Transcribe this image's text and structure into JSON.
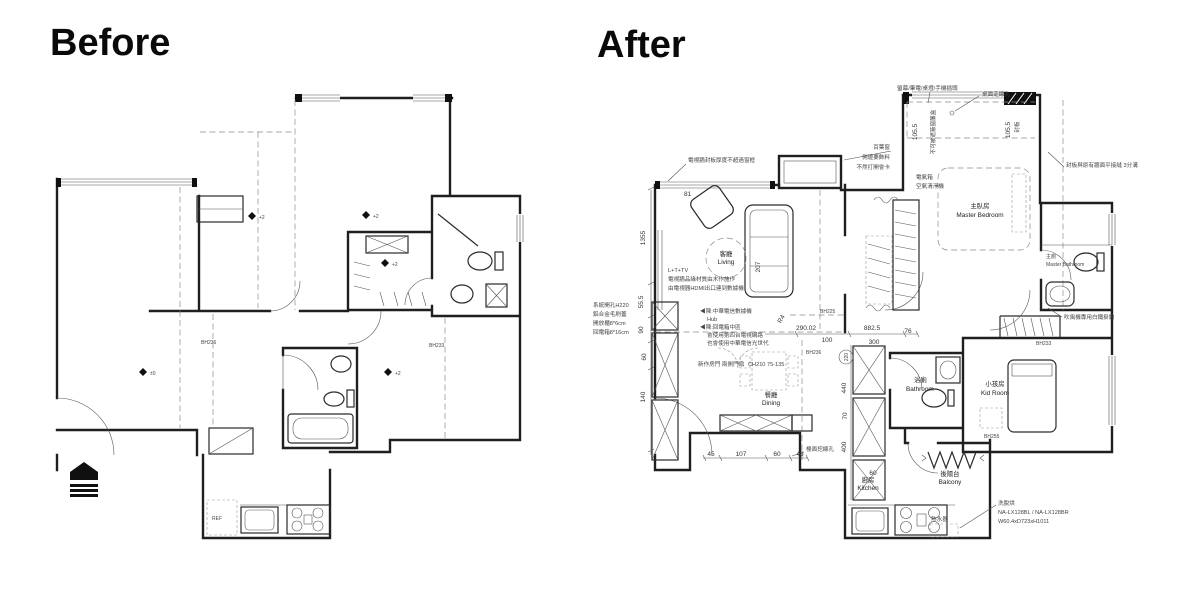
{
  "titles": {
    "before": "Before",
    "after": "After"
  },
  "before": {
    "codes": {
      "bh236": "BH236",
      "bh233": "BH233"
    },
    "kitchen": {
      "ref": "REF"
    },
    "levels": {
      "zero": "±0",
      "plus2": "+2"
    }
  },
  "after": {
    "rooms": {
      "living_zh": "客廳",
      "living_en": "Living",
      "dining_zh": "餐廳",
      "dining_en": "Dining",
      "master_zh": "主臥房",
      "master_en": "Master Bedroom",
      "masterbath_zh": "主廁",
      "masterbath_en": "Master Bathroom",
      "bath_zh": "浴廁",
      "bath_en": "Bathroom",
      "kid_zh": "小孩房",
      "kid_en": "Kid Room",
      "kitchen_zh": "廚房",
      "kitchen_en": "Kitchen",
      "balcony_zh": "後陽台",
      "balcony_en": "Balcony"
    },
    "codes": {
      "bh236": "BH236",
      "bh225": "BH225",
      "bh233": "BH233",
      "bh255": "BH255"
    },
    "notes": {
      "plug": "螢幕/筆電/桌燈/手機插頭",
      "desk_hole": "桌面走線孔",
      "tv_board": "電視牆封板厚度不超過窗框",
      "blind1": "百葉窗",
      "blind2": "側邊要飾料",
      "blind3": "不然打開會卡",
      "seam": "封板與原有牆面平接縫 3分溝",
      "curtain": "不可被遮蔽窗簾盒",
      "fengban": "封板",
      "sys1": "系統開孔H220",
      "sys2": "鋁合金毛刷蓋",
      "sys3": "開放櫃8*6cm",
      "sys4": "回電箱8*16cm",
      "tv1": "L+T+TV",
      "tv2": "電視牆品緣材質由木作施作",
      "tv3": "由電視器HDMI出口連到數據機",
      "hub1": "◀陳:中華電信數據機",
      "hub2": "Hub",
      "hub3": "◀陳:回電箱中區",
      "hub4": "會使用第四台電視網路",
      "hub5": "也會使用中華電信光世代",
      "door1": "新作房門 兩側門扇",
      "door2": "CH210 75-135",
      "elec1": "電氣箱",
      "elec2": "空氣清淨機",
      "hair": "吹風機專用白鐵掛鉤",
      "counter_hole": "檯面挖線孔",
      "heater": "熱水器",
      "washer1": "洗脫烘",
      "washer2": "NA-LX128BL / NA-LX128BR",
      "washer3": "W60.4xD723xH1011"
    },
    "dims": {
      "d1355": "1355",
      "d555": "55.5",
      "d90": "90",
      "d60l": "60",
      "d140": "140",
      "d45": "45",
      "d107": "107",
      "d60b": "60",
      "d48": "48",
      "d29002": "290.02",
      "d100": "100",
      "d8825": "882.5",
      "d76": "76",
      "d300": "300",
      "d220": "220",
      "d440": "440",
      "d70": "70",
      "d400": "400",
      "d60k": "60",
      "d1055a": "105.5",
      "d1055b": "105.5",
      "d207": "207",
      "dr4": "R4",
      "d81": "81"
    }
  }
}
